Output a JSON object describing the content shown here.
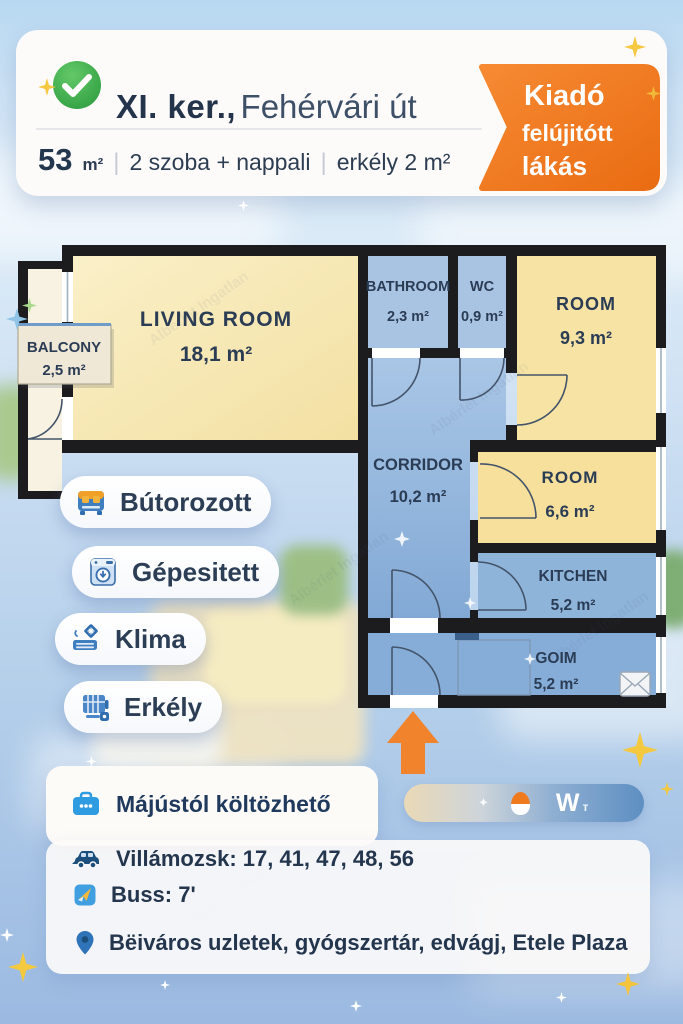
{
  "listing": {
    "district": "XI. ker.,",
    "street": "Fehérvári út",
    "size_value": "53",
    "size_unit": "m²",
    "separator": "|",
    "rooms_text": "2 szoba + nappali",
    "balcony_text": "erkély 2 m²"
  },
  "ribbon": {
    "line1": "Kiadó",
    "line2": "felújitótt",
    "line3": "lákás",
    "color": "#ed7117"
  },
  "floor_plan": {
    "rooms": {
      "balcony": {
        "name": "BALCONY",
        "area": "2,5 m²"
      },
      "living_room": {
        "name": "LIVING ROOM",
        "area": "18,1 m²"
      },
      "bathroom": {
        "name": "BATHROOM",
        "area": "2,3 m²"
      },
      "wc": {
        "name": "WC",
        "area": "0,9 m²"
      },
      "room_back": {
        "name": "ROOM",
        "area": "9,3 m²"
      },
      "corridor": {
        "name": "CORRIDOR",
        "area": "10,2 m²"
      },
      "room_front": {
        "name": "ROOM",
        "area": "6,6 m²"
      },
      "kitchen": {
        "name": "KITCHEN",
        "area": "5,2 m²"
      },
      "goim": {
        "name": "GOIM",
        "area": "5,2 m²"
      }
    }
  },
  "features": [
    {
      "label": "Bútorozott",
      "icon": "furniture-icon"
    },
    {
      "label": "Gépesitett",
      "icon": "washing-machine-icon"
    },
    {
      "label": "Klima",
      "icon": "air-conditioner-icon"
    },
    {
      "label": "Erkély",
      "icon": "balcony-railing-icon"
    }
  ],
  "details": {
    "move_in": "Májústól költözhető",
    "tram": "Villámozsk: 17, 41, 47, 48, 56",
    "bus": "Buss: 7'",
    "location": "Bëiváros uzletek, gyógszertár, edvágj, Etele Plaza"
  },
  "logo": {
    "letter": "W",
    "suffix": "т"
  },
  "watermark": "Albérlet Ingatlan",
  "colors": {
    "accent_orange": "#ed7117",
    "brand_blue": "#2f9be0",
    "navy": "#22374e",
    "wall": "#1c1c1e",
    "room_yellow": "#f6e7b2",
    "room_blue": "#8fb4da",
    "check_green": "#3fae4b"
  }
}
